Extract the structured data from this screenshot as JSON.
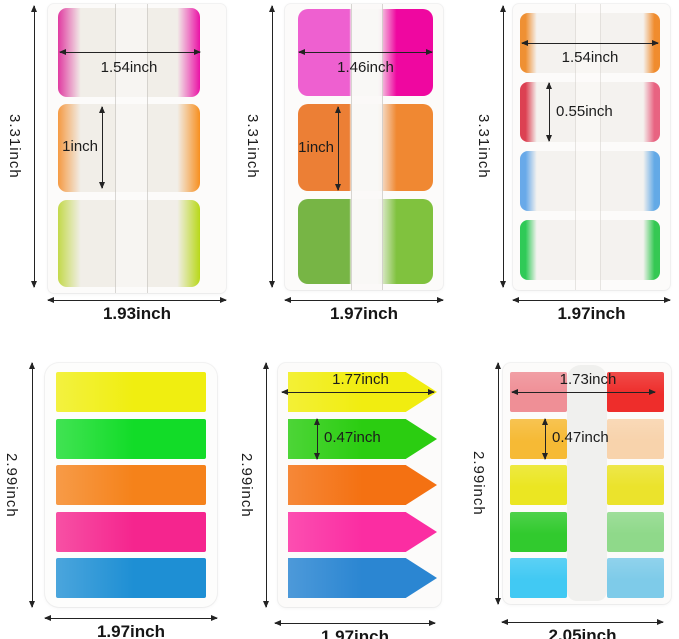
{
  "background": "#ffffff",
  "annotation_color": "#1c1c1c",
  "panels": [
    {
      "name": "3-tab pad, colored edges",
      "labels": {
        "width": "1.54inch",
        "height": "1inch",
        "side": "3.31inch",
        "bottom": "1.93inch"
      },
      "tabs": [
        {
          "left": "#e03ba1",
          "right": "#ea12a6"
        },
        {
          "left": "#f59a43",
          "right": "#f78f1f"
        },
        {
          "left": "#c3d94a",
          "right": "#b8d818"
        }
      ]
    },
    {
      "name": "3-tab pad, solid colors",
      "labels": {
        "width": "1.46inch",
        "height": "1inch",
        "side": "3.31inch",
        "bottom": "1.97inch"
      },
      "tabs": [
        {
          "left": "#ee60d0",
          "right": "#ef07a0"
        },
        {
          "left": "#ec7f35",
          "right": "#f08832"
        },
        {
          "left": "#77b545",
          "right": "#80c23e"
        }
      ]
    },
    {
      "name": "4-tab pad, colored edges",
      "labels": {
        "width": "1.54inch",
        "height": "0.55inch",
        "side": "3.31inch",
        "bottom": "1.97inch"
      },
      "tabs": [
        {
          "left": "#ef9033",
          "right": "#f08c2e"
        },
        {
          "left": "#dc4152",
          "right": "#e86381"
        },
        {
          "left": "#68a9e9",
          "right": "#63a9e6"
        },
        {
          "left": "#2fca57",
          "right": "#35c853"
        }
      ]
    },
    {
      "name": "5-strip flag pad",
      "labels": {
        "side": "2.99inch",
        "bottom": "1.97inch"
      },
      "strips": [
        "#f0ee10",
        "#12dc28",
        "#f5821a",
        "#f5258e",
        "#1e8fd4"
      ]
    },
    {
      "name": "5-arrow flag pad",
      "labels": {
        "width": "1.77inch",
        "height": "0.47inch",
        "side": "2.99inch",
        "bottom": "1.97inch"
      },
      "strips": [
        "#f1ed10",
        "#2bcd11",
        "#f47112",
        "#fb2da2",
        "#2b86d2"
      ]
    },
    {
      "name": "2-column 5-row mini tab pad",
      "labels": {
        "width": "1.73inch",
        "height": "0.47inch",
        "side": "2.99inch",
        "bottom": "2.05inch"
      },
      "left_column": [
        "#ef8f96",
        "#f6ba35",
        "#ebe622",
        "#31ca2e",
        "#41c9f3"
      ],
      "right_column": [
        "#ee2d2b",
        "#f8d3ac",
        "#ebe32c",
        "#8fd98a",
        "#7ecbe9"
      ]
    }
  ]
}
